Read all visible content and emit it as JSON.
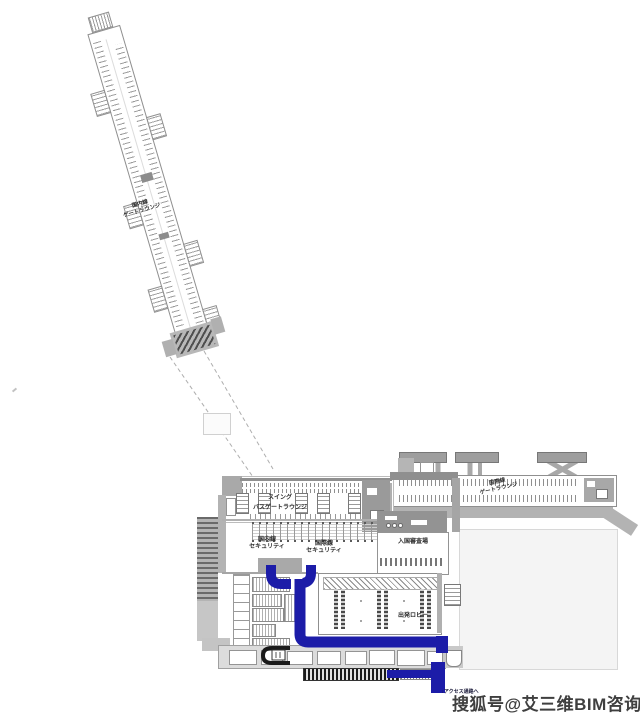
{
  "page": {
    "background": "#ffffff"
  },
  "colors": {
    "route_blue": "#1c1ca8",
    "walkway_dark": "#1a1a1a",
    "plan_gray": "#9a9a9a",
    "watermark_text_color": "#3f3f3f"
  },
  "map": {
    "domestic_pier": {
      "label_line1": "国内線",
      "label_line2": "ゲートラウンジ"
    },
    "international_pier": {
      "label_line1": "国際線",
      "label_line2": "ゲートラウンジ"
    },
    "terminal": {
      "swing_bus_gate_lounge": {
        "label_line1": "スイング",
        "label_line2": "バスゲートラウンジ"
      },
      "domestic_security": {
        "label_line1": "国内線",
        "label_line2": "セキュリティ"
      },
      "international_security": {
        "label_line1": "国際線",
        "label_line2": "セキュリティ"
      },
      "immigration": {
        "label": "入国審査場"
      },
      "departure_lobby": {
        "label": "出発ロビー"
      },
      "access_corridor": {
        "label": "↓アクセス通路へ"
      }
    }
  },
  "watermark": {
    "text": "搜狐号@艾三维BIM咨询"
  }
}
